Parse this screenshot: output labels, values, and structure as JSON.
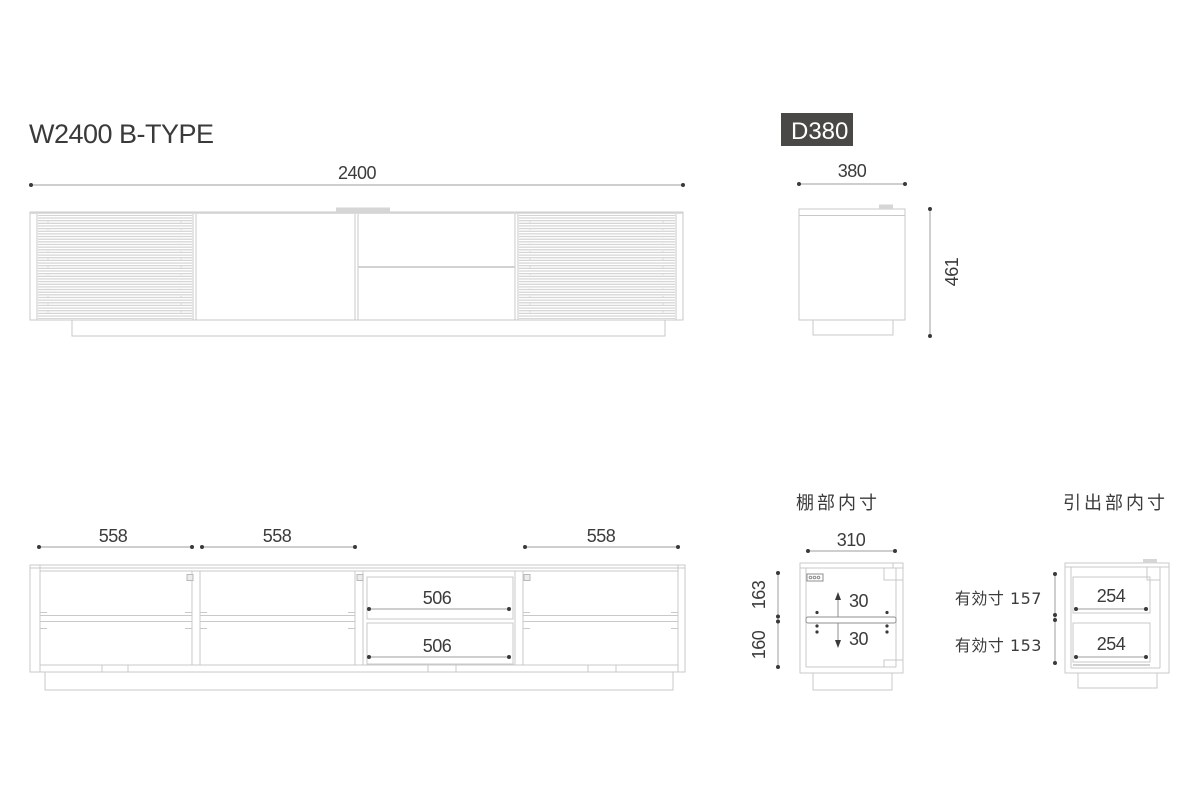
{
  "page": {
    "title": "W2400 B-TYPE"
  },
  "front_view": {
    "width_dim": "2400"
  },
  "side_view": {
    "badge": "D380",
    "width_dim": "380",
    "height_dim": "461"
  },
  "inner_view": {
    "bay_dims": [
      "558",
      "558",
      "558"
    ],
    "drawer_dims": [
      "506",
      "506"
    ]
  },
  "shelf_detail": {
    "title": "棚部内寸",
    "width_dim": "310",
    "upper_dim": "163",
    "lower_dim": "160",
    "up_adjust": "30",
    "down_adjust": "30"
  },
  "drawer_detail": {
    "title": "引出部内寸",
    "effective_top": "有効寸 157",
    "effective_bottom": "有効寸 153",
    "depth_top": "254",
    "depth_bottom": "254"
  }
}
